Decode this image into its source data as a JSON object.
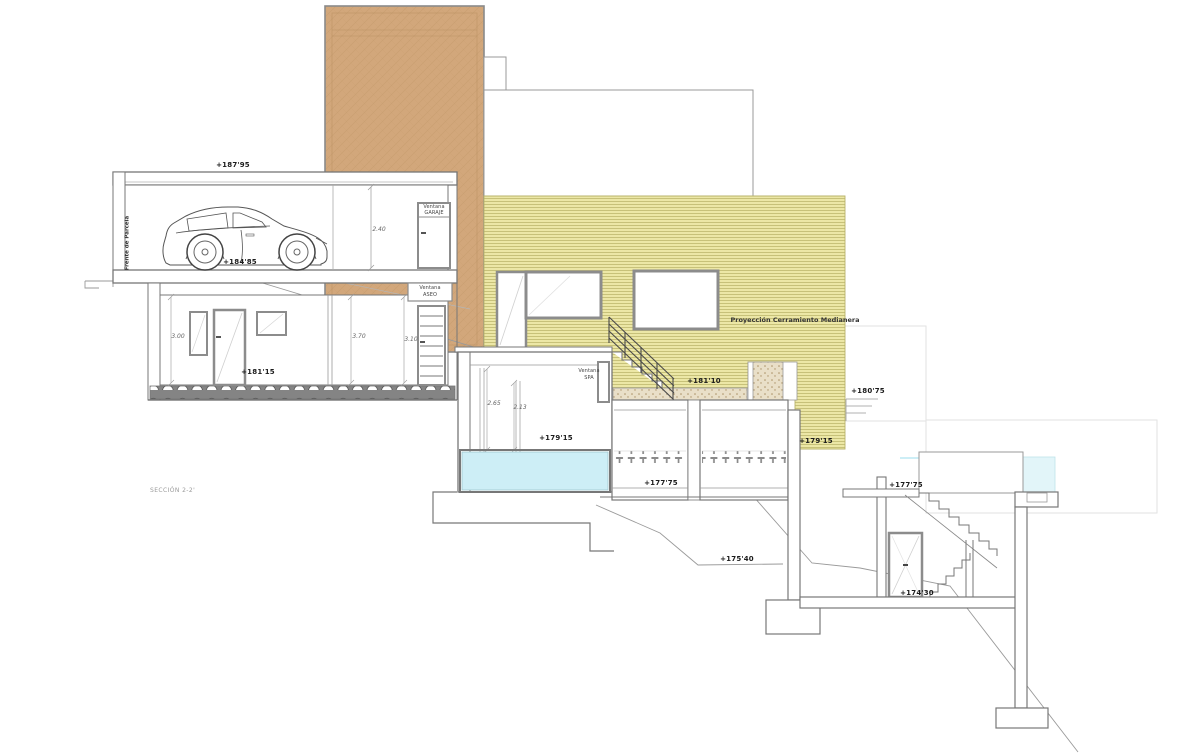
{
  "drawing": {
    "section_label": "SECCIÓN 2-2'",
    "site_note": "Frente de Parcela",
    "wall_note": "Proyección Cerramiento Medianera",
    "levels": {
      "garage_roof": "+187'95",
      "garage_floor": "+184'85",
      "ground_floor": "+181'15",
      "terrace_landing": "+181'10",
      "right_upper": "+180'75",
      "spa_floor": "+179'15",
      "wall_base": "+179'15",
      "rooms_floor": "+177'75",
      "right_rooms_floor": "+177'75",
      "lower_terrace": "+175'40",
      "basement_floor": "+174'30"
    },
    "dimensions": {
      "garage_height": "2.40",
      "room_a": "3.00",
      "room_b": "3.70",
      "room_c": "3.10",
      "spa_a": "2.65",
      "spa_b": "2.13"
    },
    "windows": {
      "garaje_l1": "Ventana",
      "garaje_l2": "GARAJE",
      "aseo_l1": "Ventana",
      "aseo_l2": "ASEO",
      "spa_l1": "Ventana",
      "spa_l2": "SPA"
    },
    "colors": {
      "party_wall_fill": "#ece7a6",
      "party_wall_line": "#c3bd74",
      "tower_fill": "#d2a77b",
      "water": "#cdeef6",
      "gravel": "#e9dfc8",
      "line": "#777777"
    }
  }
}
